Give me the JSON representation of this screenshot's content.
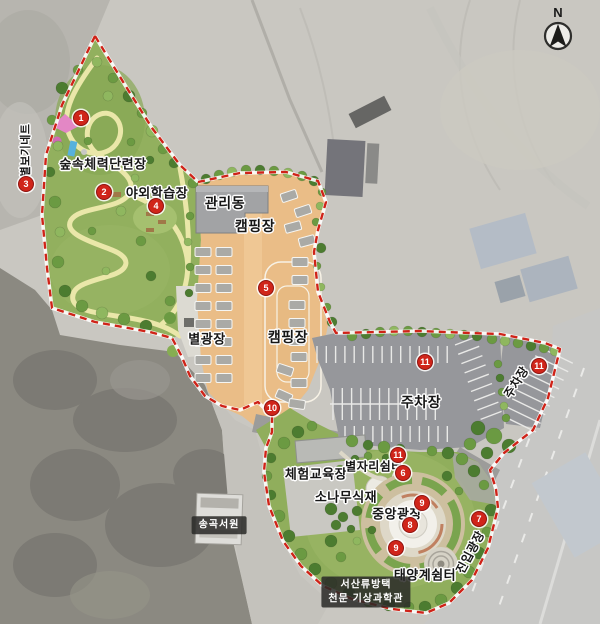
{
  "compass": {
    "label": "N"
  },
  "labels": [
    {
      "id": "forest-fitness",
      "text": "숲속체력단련장",
      "x": 103,
      "y": 163,
      "size": 13
    },
    {
      "id": "outdoor-learning",
      "text": "야외학습장",
      "x": 157,
      "y": 192,
      "size": 13
    },
    {
      "id": "star-net",
      "text": "별보기네트",
      "x": 25,
      "y": 150,
      "size": 11,
      "rotate": -90
    },
    {
      "id": "management-building",
      "text": "관리동",
      "x": 225,
      "y": 203,
      "size": 14
    },
    {
      "id": "camping-upper",
      "text": "캠핑장",
      "x": 255,
      "y": 226,
      "size": 14
    },
    {
      "id": "camping-lower",
      "text": "캠핑장",
      "x": 288,
      "y": 337,
      "size": 14
    },
    {
      "id": "star-plaza",
      "text": "별광장",
      "x": 207,
      "y": 338,
      "size": 13
    },
    {
      "id": "parking-main",
      "text": "주차장",
      "x": 421,
      "y": 402,
      "size": 14
    },
    {
      "id": "parking-east",
      "text": "주차장",
      "x": 516,
      "y": 382,
      "size": 12,
      "rotate": -58
    },
    {
      "id": "experience-education",
      "text": "체험교육장",
      "x": 316,
      "y": 473,
      "size": 13
    },
    {
      "id": "constellation-rest",
      "text": "별자리쉼터",
      "x": 374,
      "y": 466,
      "size": 12
    },
    {
      "id": "pine-planting",
      "text": "소나무식재",
      "x": 346,
      "y": 496,
      "size": 13
    },
    {
      "id": "central-plaza",
      "text": "중앙광장",
      "x": 397,
      "y": 513,
      "size": 13
    },
    {
      "id": "solar-system-rest",
      "text": "태양계쉼터",
      "x": 425,
      "y": 574,
      "size": 13
    },
    {
      "id": "entry-plaza",
      "text": "진입광장",
      "x": 470,
      "y": 552,
      "size": 12,
      "rotate": -62
    },
    {
      "id": "songgok-seowon",
      "text": "송곡서원",
      "x": 219,
      "y": 525,
      "size": 10,
      "style": "dark"
    },
    {
      "id": "museum-name",
      "lines": [
        "서산류방택",
        "천문 기상과학관"
      ],
      "x": 366,
      "y": 592,
      "size": 10,
      "style": "dark"
    }
  ],
  "markers": [
    {
      "num": "1",
      "x": 80,
      "y": 117
    },
    {
      "num": "2",
      "x": 103,
      "y": 191
    },
    {
      "num": "3",
      "x": 25,
      "y": 183
    },
    {
      "num": "4",
      "x": 155,
      "y": 205
    },
    {
      "num": "5",
      "x": 265,
      "y": 287
    },
    {
      "num": "6",
      "x": 402,
      "y": 472
    },
    {
      "num": "7",
      "x": 478,
      "y": 518
    },
    {
      "num": "8",
      "x": 409,
      "y": 524
    },
    {
      "num": "9",
      "x": 421,
      "y": 502
    },
    {
      "num": "9",
      "x": 395,
      "y": 547
    },
    {
      "num": "10",
      "x": 271,
      "y": 407
    },
    {
      "num": "11",
      "x": 424,
      "y": 361
    },
    {
      "num": "11",
      "x": 538,
      "y": 365
    },
    {
      "num": "11",
      "x": 397,
      "y": 454
    }
  ],
  "colors": {
    "boundary_red": "#cf2318",
    "marker_red": "#d0251a",
    "forest_green": "#92b05e",
    "camping_tan": "#eabd87",
    "parking_gray": "#96979b",
    "trail_yellow": "#eae7a9",
    "label_box_bg": "#2a2a28"
  }
}
